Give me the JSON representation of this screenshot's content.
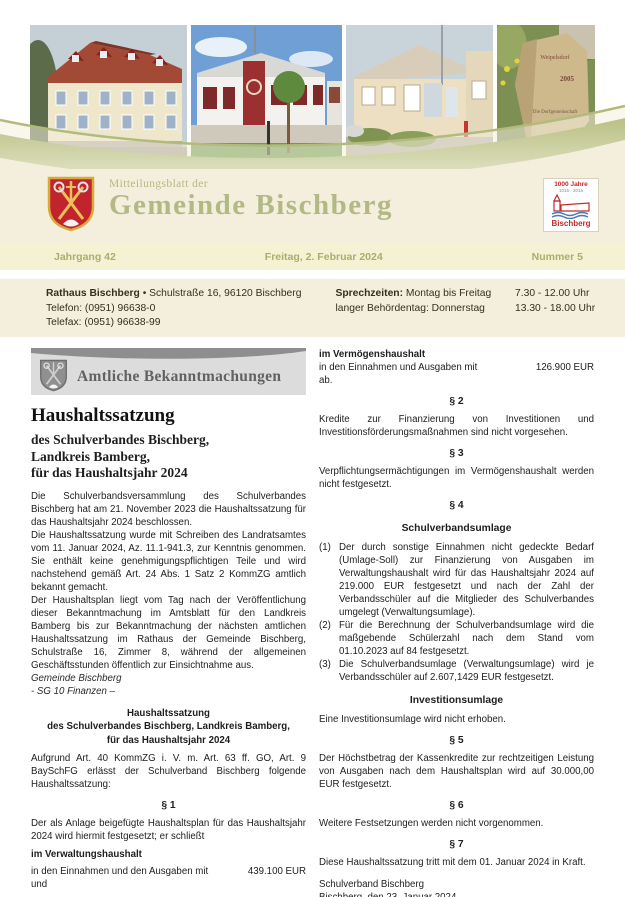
{
  "colors": {
    "cream": "#f4efdc",
    "issue_bar": "#f5f2d3",
    "olive_text": "#a9ad6e",
    "sage_title": "#b2b985",
    "banner_gray": "#dcdcdc",
    "shield_red": "#c2242e"
  },
  "photos": {
    "stone_lines": [
      "Weipelsdorf",
      "2005",
      "Die Dorfgemeinschaft"
    ]
  },
  "masthead": {
    "kicker": "Mitteilungsblatt der",
    "title": "Gemeinde Bischberg",
    "logo": {
      "line1": "1000 Jahre",
      "line2": "1015 - 2015",
      "line3": "Bischberg"
    }
  },
  "issue_bar": {
    "volume": "Jahrgang 42",
    "date": "Freitag, 2. Februar 2024",
    "number": "Nummer 5"
  },
  "contact": {
    "name": "Rathaus Bischberg",
    "address": " • Schulstraße 16, 96120 Bischberg",
    "phone": "Telefon: (0951) 96638-0",
    "fax": "Telefax: (0951) 96638-99",
    "hours_label": "Sprechzeiten:",
    "hours_row1_text": " Montag bis Freitag",
    "hours_row1_time": "7.30 - 12.00 Uhr",
    "hours_row2_text": "langer Behördentag: Donnerstag",
    "hours_row2_time": "13.30 - 18.00 Uhr"
  },
  "banner": {
    "title": "Amtliche Bekanntmachungen"
  },
  "article": {
    "left": {
      "title": "Haushaltssatzung",
      "subtitle_lines": [
        "des Schulverbandes Bischberg,",
        "Landkreis Bamberg,",
        "für das Haushaltsjahr 2024"
      ],
      "para1": "Die Schulverbandsversammlung des Schulverbandes Bischberg hat am 21. November 2023 die Haushaltssatzung für das Haushaltsjahr 2024 beschlossen.",
      "para2": "Die Haushaltssatzung wurde mit Schreiben des Landratsamtes vom 11. Januar 2024, Az. 11.1-941.3, zur Kenntnis genommen. Sie enthält keine genehmigungspflichtigen Teile und wird nachstehend gemäß Art. 24 Abs. 1 Satz 2 KommZG amtlich bekannt gemacht.",
      "para3": "Der Haushaltsplan liegt vom Tag nach der Veröffentlichung dieser Bekanntmachung im Amtsblatt für den Landkreis Bamberg bis zur Bekanntmachung der nächsten amtlichen Haushaltssatzung im Rathaus der Gemeinde Bischberg, Schulstraße 16, Zimmer 8, während der allgemeinen Geschäftsstunden öffentlich zur Einsichtnahme aus.",
      "issuer": "Gemeinde Bischberg",
      "issuer_dept": "- SG 10 Finanzen –",
      "center_heading_lines": [
        "Haushaltssatzung",
        "des Schulverbandes Bischberg, Landkreis Bamberg,",
        "für das Haushaltsjahr 2024"
      ],
      "para4": "Aufgrund Art. 40 KommZG i. V. m. Art. 63 ff. GO, Art. 9 BaySchFG erlässt der Schulverband Bischberg folgende Haushaltssatzung:",
      "s1": "§ 1",
      "para5": "Der als Anlage beigefügte Haushaltsplan für das Haushaltsjahr 2024 wird hiermit festgesetzt; er schließt",
      "vwh_label": "im Verwaltungshaushalt",
      "vwh_text": "in den Einnahmen und den Ausgaben mit",
      "vwh_amount": "439.100 EUR",
      "und": "und"
    },
    "right": {
      "vmh_label": "im Vermögenshaushalt",
      "vmh_text": "in den Einnahmen und Ausgaben mit",
      "vmh_amount": "126.900 EUR",
      "ab": "ab.",
      "s2": "§ 2",
      "s2_text": "Kredite zur Finanzierung von Investitionen und Investitionsförderungsmaßnahmen sind nicht vorgesehen.",
      "s3": "§ 3",
      "s3_text": "Verpflichtungsermächtigungen im Vermögenshaushalt werden nicht festgesetzt.",
      "s4": "§ 4",
      "s4_heading": "Schulverbandsumlage",
      "s4_items": [
        {
          "num": "(1)",
          "text": "Der durch sonstige Einnahmen nicht gedeckte Bedarf (Umlage-Soll) zur Finanzierung von Ausgaben im Verwaltungshaushalt wird für das Haushaltsjahr 2024 auf 219.000 EUR festgesetzt und nach der Zahl der Verbandsschüler auf die Mitglieder des Schulverbandes umgelegt (Verwaltungsumlage)."
        },
        {
          "num": "(2)",
          "text": "Für die Berechnung der Schulverbandsumlage wird die maßgebende Schülerzahl nach dem Stand vom 01.10.2023 auf 84 festgesetzt."
        },
        {
          "num": "(3)",
          "text": "Die Schulverbandsumlage (Verwaltungsumlage) wird je Verbandsschüler auf 2.607,1429 EUR festgesetzt."
        }
      ],
      "inv_heading": "Investitionsumlage",
      "inv_text": "Eine Investitionsumlage wird nicht erhoben.",
      "s5": "§ 5",
      "s5_text": "Der Höchstbetrag der Kassenkredite zur rechtzeitigen Leistung von Ausgaben nach dem Haushaltsplan wird auf 30.000,00 EUR festgesetzt.",
      "s6": "§ 6",
      "s6_text": "Weitere Festsetzungen werden nicht vorgenommen.",
      "s7": "§ 7",
      "s7_text": "Diese Haushaltssatzung tritt mit dem 01. Januar 2024 in Kraft.",
      "sig_org": "Schulverband Bischberg",
      "sig_place_date": "Bischberg, den 23. Januar 2024",
      "sig_name": "Michael Dütsch",
      "sig_role": "Schulverbandsvorsitzender"
    }
  }
}
